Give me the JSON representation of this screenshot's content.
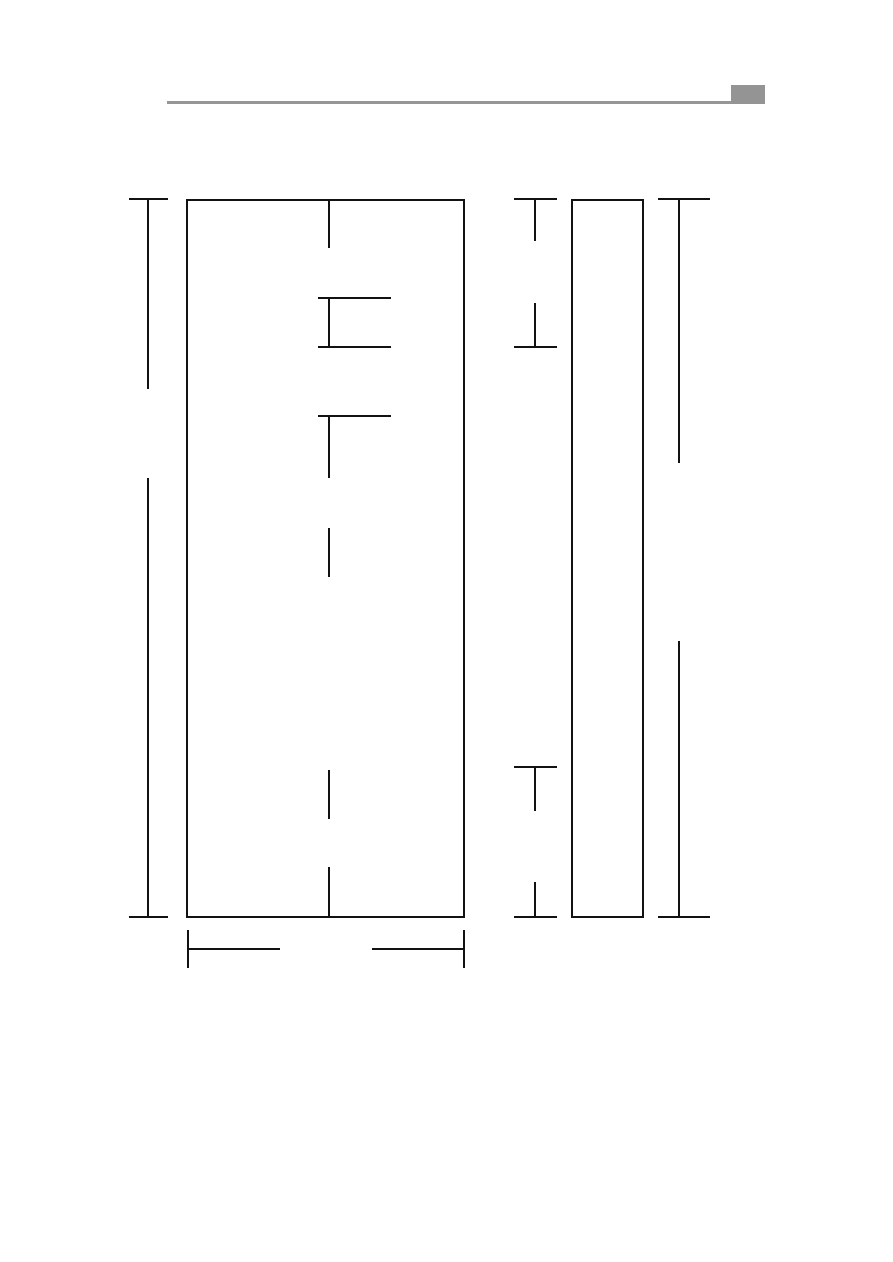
{
  "page": {
    "width": 893,
    "height": 1262,
    "background": "#ffffff"
  },
  "header": {
    "rule_color": "#969696",
    "tab_color": "#949494"
  },
  "diagram": {
    "stroke_color": "#121212",
    "stroke_width": 2,
    "rects": [
      {
        "name": "header-rule",
        "x": 167,
        "y": 101,
        "width": 564,
        "height": 3,
        "fill": "#969696",
        "stroke": false
      },
      {
        "name": "header-corner-tab",
        "x": 731,
        "y": 85,
        "width": 34,
        "height": 19,
        "fill": "#949494",
        "stroke": false
      },
      {
        "name": "front-view-outline",
        "x": 187,
        "y": 200,
        "width": 277,
        "height": 717,
        "fill": "none",
        "stroke": true
      },
      {
        "name": "side-view-outline",
        "x": 572,
        "y": 200,
        "width": 71,
        "height": 717,
        "fill": "none",
        "stroke": true
      }
    ],
    "segments": [
      {
        "name": "left-height-dim-top-tick",
        "x1": 129,
        "y1": 199,
        "x2": 168,
        "y2": 199
      },
      {
        "name": "left-height-dim-line-upper",
        "x1": 148,
        "y1": 199,
        "x2": 148,
        "y2": 389
      },
      {
        "name": "left-height-dim-line-lower",
        "x1": 148,
        "y1": 478,
        "x2": 148,
        "y2": 917
      },
      {
        "name": "left-height-dim-bottom-tick",
        "x1": 129,
        "y1": 917,
        "x2": 168,
        "y2": 917
      },
      {
        "name": "center-line-segment-1",
        "x1": 329,
        "y1": 200,
        "x2": 329,
        "y2": 248
      },
      {
        "name": "center-line-segment-2",
        "x1": 329,
        "y1": 298,
        "x2": 329,
        "y2": 347
      },
      {
        "name": "center-line-segment-3",
        "x1": 329,
        "y1": 416,
        "x2": 329,
        "y2": 478
      },
      {
        "name": "center-line-segment-4",
        "x1": 329,
        "y1": 528,
        "x2": 329,
        "y2": 577
      },
      {
        "name": "center-line-segment-5",
        "x1": 329,
        "y1": 770,
        "x2": 329,
        "y2": 819
      },
      {
        "name": "center-line-segment-6",
        "x1": 329,
        "y1": 867,
        "x2": 329,
        "y2": 917
      },
      {
        "name": "detail-line-upper",
        "x1": 318,
        "y1": 298,
        "x2": 391,
        "y2": 298
      },
      {
        "name": "detail-line-middle",
        "x1": 318,
        "y1": 347,
        "x2": 391,
        "y2": 347
      },
      {
        "name": "detail-line-lower",
        "x1": 318,
        "y1": 416,
        "x2": 391,
        "y2": 416
      },
      {
        "name": "bottom-width-dim-left-ext",
        "x1": 188,
        "y1": 930,
        "x2": 188,
        "y2": 968
      },
      {
        "name": "bottom-width-dim-line-left",
        "x1": 188,
        "y1": 949,
        "x2": 280,
        "y2": 949
      },
      {
        "name": "bottom-width-dim-line-right",
        "x1": 372,
        "y1": 949,
        "x2": 464,
        "y2": 949
      },
      {
        "name": "bottom-width-dim-right-ext",
        "x1": 464,
        "y1": 930,
        "x2": 464,
        "y2": 968
      },
      {
        "name": "mid-dim-upper-top-tick",
        "x1": 514,
        "y1": 199,
        "x2": 557,
        "y2": 199
      },
      {
        "name": "mid-dim-upper-line-a",
        "x1": 535,
        "y1": 199,
        "x2": 535,
        "y2": 241
      },
      {
        "name": "mid-dim-upper-line-b",
        "x1": 535,
        "y1": 303,
        "x2": 535,
        "y2": 347
      },
      {
        "name": "mid-dim-upper-bottom-tick",
        "x1": 514,
        "y1": 347,
        "x2": 557,
        "y2": 347
      },
      {
        "name": "mid-dim-lower-top-tick",
        "x1": 514,
        "y1": 767,
        "x2": 557,
        "y2": 767
      },
      {
        "name": "mid-dim-lower-line-a",
        "x1": 535,
        "y1": 767,
        "x2": 535,
        "y2": 811
      },
      {
        "name": "mid-dim-lower-line-b",
        "x1": 535,
        "y1": 882,
        "x2": 535,
        "y2": 917
      },
      {
        "name": "mid-dim-lower-bottom-tick",
        "x1": 514,
        "y1": 917,
        "x2": 557,
        "y2": 917
      },
      {
        "name": "right-height-dim-top-tick",
        "x1": 658,
        "y1": 199,
        "x2": 710,
        "y2": 199
      },
      {
        "name": "right-height-dim-line-upper",
        "x1": 679,
        "y1": 199,
        "x2": 679,
        "y2": 463
      },
      {
        "name": "right-height-dim-line-lower",
        "x1": 679,
        "y1": 641,
        "x2": 679,
        "y2": 917
      },
      {
        "name": "right-height-dim-bottom-tick",
        "x1": 658,
        "y1": 917,
        "x2": 710,
        "y2": 917
      }
    ]
  }
}
